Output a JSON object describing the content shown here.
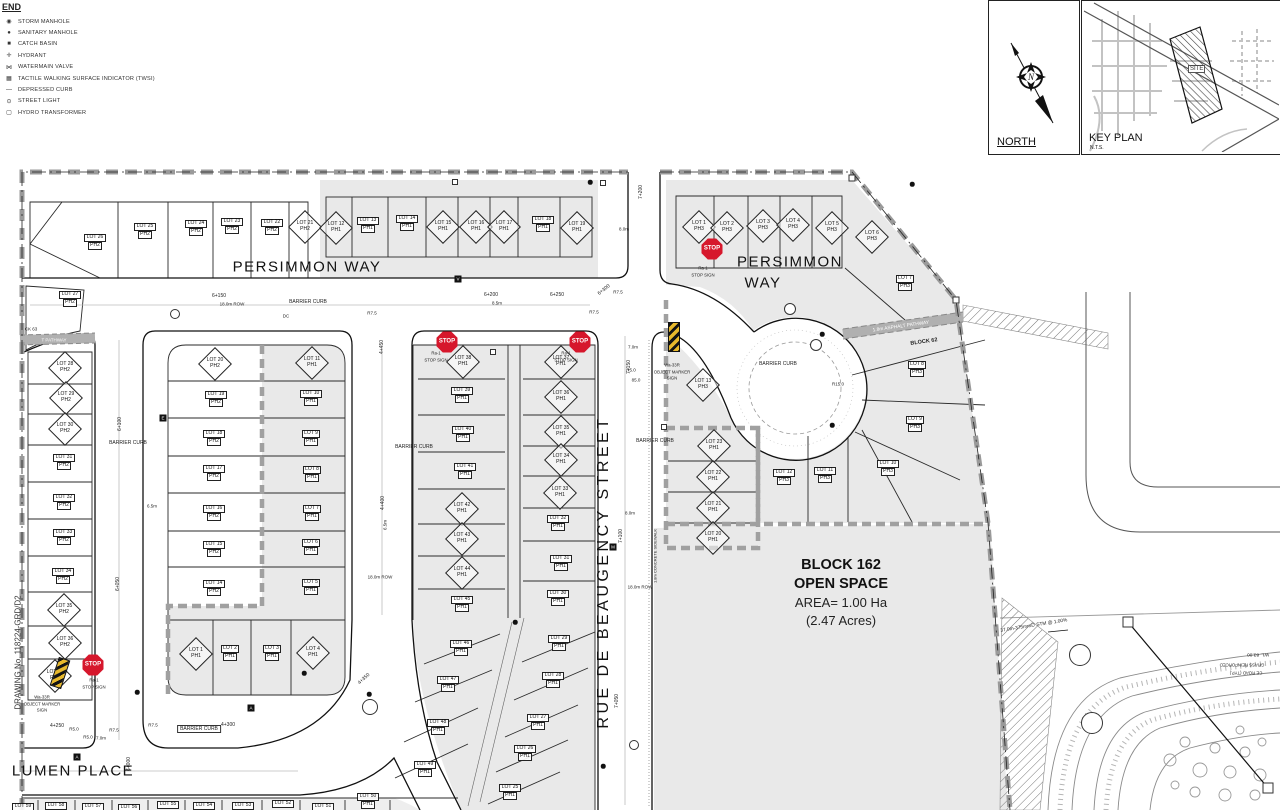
{
  "legend": {
    "title": "END",
    "items": [
      {
        "label": "STORM MANHOLE",
        "icon": "storm-manhole-icon",
        "glyph": "◉"
      },
      {
        "label": "SANITARY MANHOLE",
        "icon": "sanitary-manhole-icon",
        "glyph": "●"
      },
      {
        "label": "CATCH BASIN",
        "icon": "catch-basin-icon",
        "glyph": "■"
      },
      {
        "label": "HYDRANT",
        "icon": "hydrant-icon",
        "glyph": "✛"
      },
      {
        "label": "WATERMAIN VALVE",
        "icon": "watermain-valve-icon",
        "glyph": "⋈"
      },
      {
        "label": "TACTILE WALKING SURFACE INDICATOR (TWSI)",
        "icon": "twsi-icon",
        "glyph": "▦"
      },
      {
        "label": "DEPRESSED CURB",
        "icon": "depressed-curb-icon",
        "glyph": "—"
      },
      {
        "label": "STREET LIGHT",
        "icon": "street-light-icon",
        "glyph": "⊙"
      },
      {
        "label": "HYDRO TRANSFORMER",
        "icon": "hydro-transformer-icon",
        "glyph": "▢"
      }
    ]
  },
  "north_box": {
    "label": "NORTH"
  },
  "key_plan": {
    "label": "KEY PLAN",
    "scale": "N.T.S.",
    "site": "SITE"
  },
  "drawing_no": "DRAWING No. 118224-GRD/D2",
  "open_space": {
    "lines": [
      "BLOCK 162",
      "OPEN SPACE",
      "AREA= 1.00 Ha",
      "(2.47 Acres)"
    ]
  },
  "streets": [
    {
      "name": "PERSIMMON WAY",
      "x": 307,
      "y": 267,
      "fs": 15,
      "ls": 1.5,
      "rot": 0
    },
    {
      "name": "PERSIMMON",
      "x": 790,
      "y": 262,
      "fs": 15,
      "ls": 1.5,
      "rot": 0
    },
    {
      "name": "WAY",
      "x": 763,
      "y": 283,
      "fs": 15,
      "ls": 1.5,
      "rot": 0
    },
    {
      "name": "RUE DE BEAUGENCY STREET",
      "x": 604,
      "y": 572,
      "fs": 16,
      "ls": 3.5,
      "rot": -90
    },
    {
      "name": "LUMEN PLACE",
      "x": 73,
      "y": 771,
      "fs": 15,
      "ls": 1.5,
      "rot": 0
    }
  ],
  "lots": [
    [
      "LOT 26",
      "PH2",
      "r",
      95,
      242
    ],
    [
      "LOT 25",
      "PH2",
      "r",
      145,
      231
    ],
    [
      "LOT 24",
      "PH2",
      "r",
      196,
      228
    ],
    [
      "LOT 23",
      "PH2",
      "r",
      232,
      226
    ],
    [
      "LOT 22",
      "PH2",
      "r",
      272,
      227
    ],
    [
      "LOT 21",
      "PH2",
      "d",
      305,
      227
    ],
    [
      "LOT 27",
      "PH2",
      "r",
      70,
      299
    ],
    [
      "LOT 12",
      "PH1",
      "d",
      336,
      228
    ],
    [
      "LOT 13",
      "PH1",
      "r",
      368,
      225
    ],
    [
      "LOT 14",
      "PH1",
      "r",
      407,
      223
    ],
    [
      "LOT 15",
      "PH1",
      "d",
      443,
      227
    ],
    [
      "LOT 16",
      "PH1",
      "d",
      476,
      227
    ],
    [
      "LOT 17",
      "PH1",
      "d",
      504,
      227
    ],
    [
      "LOT 18",
      "PH1",
      "r",
      543,
      224
    ],
    [
      "LOT 19",
      "PH1",
      "d",
      577,
      228
    ],
    [
      "LOT 1",
      "PH3",
      "d",
      699,
      227
    ],
    [
      "LOT 2",
      "PH3",
      "d",
      727,
      228
    ],
    [
      "LOT 3",
      "PH3",
      "d",
      763,
      226
    ],
    [
      "LOT 4",
      "PH3",
      "d",
      793,
      225
    ],
    [
      "LOT 5",
      "PH3",
      "d",
      832,
      228
    ],
    [
      "LOT 6",
      "PH3",
      "d",
      872,
      237
    ],
    [
      "LOT 7",
      "PH3",
      "r",
      905,
      283
    ],
    [
      "LOT 8",
      "PH3",
      "r",
      917,
      369
    ],
    [
      "LOT 9",
      "PH3",
      "r",
      915,
      424
    ],
    [
      "LOT 10",
      "PH3",
      "r",
      888,
      468
    ],
    [
      "LOT 11",
      "PH3",
      "r",
      825,
      475
    ],
    [
      "LOT 12",
      "PH3",
      "r",
      784,
      477
    ],
    [
      "LOT 13",
      "PH3",
      "d",
      703,
      385
    ],
    [
      "LOT 28",
      "PH2",
      "d",
      65,
      368
    ],
    [
      "LOT 29",
      "PH2",
      "d",
      66,
      398
    ],
    [
      "LOT 30",
      "PH2",
      "d",
      65,
      429
    ],
    [
      "LOT 31",
      "PH2",
      "r",
      64,
      462
    ],
    [
      "LOT 32",
      "PH2",
      "r",
      64,
      502
    ],
    [
      "LOT 33",
      "PH2",
      "r",
      64,
      537
    ],
    [
      "LOT 34",
      "PH2",
      "r",
      63,
      576
    ],
    [
      "LOT 35",
      "PH2",
      "d",
      64,
      610
    ],
    [
      "LOT 36",
      "PH2",
      "d",
      65,
      643
    ],
    [
      "LOT 37",
      "PH2",
      "d",
      55,
      676
    ],
    [
      "LOT 20",
      "PH2",
      "d",
      215,
      364
    ],
    [
      "LOT 19",
      "PH2",
      "r",
      216,
      399
    ],
    [
      "LOT 18",
      "PH2",
      "r",
      214,
      438
    ],
    [
      "LOT 17",
      "PH2",
      "r",
      214,
      473
    ],
    [
      "LOT 16",
      "PH2",
      "r",
      214,
      513
    ],
    [
      "LOT 15",
      "PH2",
      "r",
      214,
      549
    ],
    [
      "LOT 14",
      "PH2",
      "r",
      214,
      588
    ],
    [
      "LOT 11",
      "PH1",
      "d",
      312,
      363
    ],
    [
      "LOT 10",
      "PH1",
      "r",
      311,
      398
    ],
    [
      "LOT 9",
      "PH1",
      "r",
      311,
      438
    ],
    [
      "LOT 8",
      "PH1",
      "r",
      312,
      474
    ],
    [
      "LOT 7",
      "PH1",
      "r",
      312,
      513
    ],
    [
      "LOT 6",
      "PH1",
      "r",
      311,
      547
    ],
    [
      "LOT 5",
      "PH1",
      "r",
      311,
      587
    ],
    [
      "LOT 1",
      "PH1",
      "d",
      196,
      654
    ],
    [
      "LOT 2",
      "PH1",
      "r",
      230,
      653
    ],
    [
      "LOT 3",
      "PH1",
      "r",
      272,
      653
    ],
    [
      "LOT 4",
      "PH1",
      "d",
      313,
      653
    ],
    [
      "LOT 38",
      "PH1",
      "d",
      463,
      362
    ],
    [
      "LOT 39",
      "PH1",
      "r",
      462,
      395
    ],
    [
      "LOT 40",
      "PH1",
      "r",
      463,
      434
    ],
    [
      "LOT 41",
      "PH1",
      "r",
      465,
      471
    ],
    [
      "LOT 42",
      "PH1",
      "d",
      462,
      509
    ],
    [
      "LOT 43",
      "PH1",
      "d",
      462,
      539
    ],
    [
      "LOT 44",
      "PH1",
      "d",
      462,
      573
    ],
    [
      "LOT 45",
      "PH1",
      "r",
      462,
      604
    ],
    [
      "LOT 37",
      "PH1",
      "d",
      561,
      362
    ],
    [
      "LOT 36",
      "PH1",
      "d",
      561,
      397
    ],
    [
      "LOT 35",
      "PH1",
      "d",
      561,
      432
    ],
    [
      "LOT 34",
      "PH1",
      "d",
      561,
      460
    ],
    [
      "LOT 33",
      "PH1",
      "d",
      560,
      493
    ],
    [
      "LOT 32",
      "PH1",
      "r",
      558,
      523
    ],
    [
      "LOT 31",
      "PH1",
      "r",
      561,
      563
    ],
    [
      "LOT 30",
      "PH1",
      "r",
      558,
      598
    ],
    [
      "LOT 46",
      "PH1",
      "r",
      461,
      648
    ],
    [
      "LOT 47",
      "PH1",
      "r",
      448,
      684
    ],
    [
      "LOT 48",
      "PH1",
      "r",
      438,
      727
    ],
    [
      "LOT 49",
      "PH1",
      "r",
      425,
      769
    ],
    [
      "LOT 29",
      "PH1",
      "r",
      559,
      643
    ],
    [
      "LOT 28",
      "PH1",
      "r",
      553,
      680
    ],
    [
      "LOT 27",
      "PH1",
      "r",
      538,
      722
    ],
    [
      "LOT 26",
      "PH1",
      "r",
      525,
      753
    ],
    [
      "LOT 25",
      "PH1",
      "r",
      510,
      792
    ],
    [
      "LOT 23",
      "PH1",
      "d",
      714,
      446
    ],
    [
      "LOT 22",
      "PH1",
      "d",
      713,
      477
    ],
    [
      "LOT 21",
      "PH1",
      "d",
      713,
      508
    ],
    [
      "LOT 20",
      "PH1",
      "d",
      713,
      538
    ],
    [
      "LOT 59",
      "",
      "r",
      23,
      807
    ],
    [
      "LOT 58",
      "",
      "r",
      56,
      806
    ],
    [
      "LOT 57",
      "",
      "r",
      93,
      807
    ],
    [
      "LOT 56",
      "",
      "r",
      129,
      808
    ],
    [
      "LOT 55",
      "",
      "r",
      168,
      805
    ],
    [
      "LOT 54",
      "",
      "r",
      204,
      806
    ],
    [
      "LOT 53",
      "",
      "r",
      243,
      806
    ],
    [
      "LOT 52",
      "",
      "r",
      283,
      804
    ],
    [
      "LOT 51",
      "",
      "r",
      323,
      807
    ],
    [
      "LOT 50",
      "PH1",
      "r",
      368,
      801
    ]
  ],
  "annotations": [
    {
      "t": "BARRIER CURB",
      "x": 308,
      "y": 302,
      "fs": 5
    },
    {
      "t": "BARRIER CURB",
      "x": 128,
      "y": 443,
      "fs": 5
    },
    {
      "t": "BARRIER CURB",
      "x": 414,
      "y": 447,
      "fs": 5
    },
    {
      "t": "BARRIER CURB",
      "x": 655,
      "y": 441,
      "fs": 5
    },
    {
      "t": "BARRIER CURB",
      "x": 778,
      "y": 364,
      "fs": 5
    },
    {
      "t": "BARRIER CURB",
      "x": 199,
      "y": 729,
      "fs": 5,
      "boxed": true
    },
    {
      "t": "6+150",
      "x": 219,
      "y": 296,
      "fs": 5
    },
    {
      "t": "18.0m ROW",
      "x": 232,
      "y": 304,
      "fs": 4.5
    },
    {
      "t": "6+200",
      "x": 491,
      "y": 295,
      "fs": 5
    },
    {
      "t": "8.5m",
      "x": 497,
      "y": 303,
      "fs": 4.5
    },
    {
      "t": "6+250",
      "x": 557,
      "y": 295,
      "fs": 5
    },
    {
      "t": "6+300",
      "x": 604,
      "y": 290,
      "fs": 5,
      "rot": -38
    },
    {
      "t": "R7.5",
      "x": 594,
      "y": 312,
      "fs": 4.5
    },
    {
      "t": "R7.5",
      "x": 372,
      "y": 313,
      "fs": 4.5
    },
    {
      "t": "R7.5",
      "x": 618,
      "y": 292,
      "fs": 4.5
    },
    {
      "t": "7+200",
      "x": 641,
      "y": 192,
      "fs": 5,
      "rot": -90
    },
    {
      "t": "8.0m",
      "x": 624,
      "y": 229,
      "fs": 4.5
    },
    {
      "t": "DC",
      "x": 286,
      "y": 316,
      "fs": 4.5
    },
    {
      "t": "6+100",
      "x": 120,
      "y": 424,
      "fs": 5,
      "rot": -90
    },
    {
      "t": "6+050",
      "x": 118,
      "y": 584,
      "fs": 5,
      "rot": -90
    },
    {
      "t": "6.5m",
      "x": 152,
      "y": 506,
      "fs": 4.5
    },
    {
      "t": "4+450",
      "x": 382,
      "y": 347,
      "fs": 5,
      "rot": -90
    },
    {
      "t": "4+400",
      "x": 383,
      "y": 503,
      "fs": 5,
      "rot": -90
    },
    {
      "t": "6.5m",
      "x": 385,
      "y": 525,
      "fs": 4.5,
      "rot": -90
    },
    {
      "t": "18.0m ROW",
      "x": 380,
      "y": 577,
      "fs": 4.5
    },
    {
      "t": "7+150",
      "x": 629,
      "y": 367,
      "fs": 5,
      "rot": -90
    },
    {
      "t": "7.0m",
      "x": 633,
      "y": 347,
      "fs": 4.5
    },
    {
      "t": "R5.0",
      "x": 631,
      "y": 370,
      "fs": 4.5
    },
    {
      "t": "85.0",
      "x": 636,
      "y": 380,
      "fs": 4.5
    },
    {
      "t": "7+100",
      "x": 621,
      "y": 536,
      "fs": 5,
      "rot": -90
    },
    {
      "t": "8.0m",
      "x": 630,
      "y": 513,
      "fs": 4.5
    },
    {
      "t": "18.0m ROW",
      "x": 640,
      "y": 587,
      "fs": 4.5
    },
    {
      "t": "1.8m CONCRETE SIDEWALK",
      "x": 655,
      "y": 556,
      "fs": 4,
      "rot": -90
    },
    {
      "t": "7+050",
      "x": 617,
      "y": 701,
      "fs": 5,
      "rot": -90
    },
    {
      "t": "R15.0",
      "x": 838,
      "y": 384,
      "fs": 4.5
    },
    {
      "t": "4+250",
      "x": 57,
      "y": 726,
      "fs": 5
    },
    {
      "t": "R5.0",
      "x": 74,
      "y": 729,
      "fs": 4.5
    },
    {
      "t": "R5.0",
      "x": 88,
      "y": 737,
      "fs": 4.5
    },
    {
      "t": "7.0m",
      "x": 101,
      "y": 738,
      "fs": 4.5
    },
    {
      "t": "R7.5",
      "x": 114,
      "y": 730,
      "fs": 4.5
    },
    {
      "t": "R7.5",
      "x": 153,
      "y": 725,
      "fs": 4.5
    },
    {
      "t": "4+300",
      "x": 228,
      "y": 725,
      "fs": 5
    },
    {
      "t": "6+000",
      "x": 129,
      "y": 764,
      "fs": 5,
      "rot": -90
    },
    {
      "t": "4+350",
      "x": 364,
      "y": 679,
      "fs": 5,
      "rot": -42
    },
    {
      "t": "CK 63",
      "x": 31,
      "y": 329,
      "fs": 4.5
    },
    {
      "t": "T PATHWAY",
      "x": 54,
      "y": 340,
      "fs": 4.5,
      "white": true
    },
    {
      "t": "1.8m ASPHALT PATHWAY",
      "x": 901,
      "y": 327,
      "fs": 4.8,
      "rot": -8,
      "white": true
    },
    {
      "t": "BLOCK 62",
      "x": 924,
      "y": 342,
      "fs": 5.5,
      "rot": -8,
      "bold": true
    },
    {
      "t": "37.0m-375mm∅ STM @ 1.00%",
      "x": 1034,
      "y": 626,
      "fs": 4.8,
      "rot": -9
    },
    {
      "t": "WL. 83.00",
      "x": 1258,
      "y": 654,
      "fs": 4.8,
      "rot": 180
    },
    {
      "t": "GRASS REINFORCED",
      "x": 1242,
      "y": 665,
      "fs": 4.3,
      "rot": 180
    },
    {
      "t": "CE ROAD (TYP.)",
      "x": 1246,
      "y": 673,
      "fs": 4.3,
      "rot": 180
    }
  ],
  "signs": {
    "stop_text": "STOP",
    "stops": [
      {
        "x": 712,
        "y": 249,
        "lines": [
          "Ra-1",
          "STOP SIGN"
        ],
        "lx": 703,
        "ly": 268
      },
      {
        "x": 447,
        "y": 342,
        "lines": [
          "Ra-1",
          "STOP SIGN"
        ],
        "lx": 436,
        "ly": 353
      },
      {
        "x": 580,
        "y": 342,
        "lines": [
          "Ra-1",
          "STOP SIGN"
        ],
        "lx": 566,
        "ly": 353
      },
      {
        "x": 93,
        "y": 665,
        "lines": [
          "Ra-1",
          "STOP SIGN"
        ],
        "lx": 94,
        "ly": 680
      }
    ],
    "markers": [
      {
        "x": 674,
        "y": 337,
        "rot": 0,
        "lines": [
          "Wa-33R",
          "OBJECT MARKER",
          "SIGN"
        ],
        "lx": 672,
        "ly": 365
      },
      {
        "x": 60,
        "y": 673,
        "rot": 18,
        "lines": [
          "Wa-33R",
          "OBJECT MARKER",
          "SIGN"
        ],
        "lx": 42,
        "ly": 697
      }
    ]
  },
  "symbols": {
    "dots": [
      [
        590,
        182
      ],
      [
        912,
        184
      ],
      [
        822,
        334
      ],
      [
        832,
        425
      ],
      [
        137,
        692
      ],
      [
        515,
        622
      ],
      [
        304,
        673
      ],
      [
        603,
        766
      ],
      [
        369,
        694
      ]
    ],
    "circles": [
      [
        816,
        345,
        10
      ],
      [
        790,
        309,
        10
      ],
      [
        175,
        314,
        8
      ],
      [
        370,
        707,
        14
      ],
      [
        1080,
        655,
        20
      ],
      [
        1092,
        723,
        20
      ],
      [
        634,
        745,
        8
      ]
    ],
    "squares": [
      [
        852,
        178,
        5
      ],
      [
        956,
        300,
        5
      ],
      [
        455,
        182,
        4
      ],
      [
        603,
        183,
        4
      ],
      [
        493,
        352,
        4
      ],
      [
        664,
        427,
        4
      ],
      [
        1128,
        622,
        9
      ],
      [
        1268,
        788,
        9
      ]
    ],
    "bsquares": [
      [
        458,
        279,
        "V"
      ],
      [
        251,
        708,
        "A"
      ],
      [
        613,
        547,
        "M"
      ],
      [
        163,
        418,
        "E"
      ],
      [
        77,
        757,
        "A"
      ]
    ]
  }
}
